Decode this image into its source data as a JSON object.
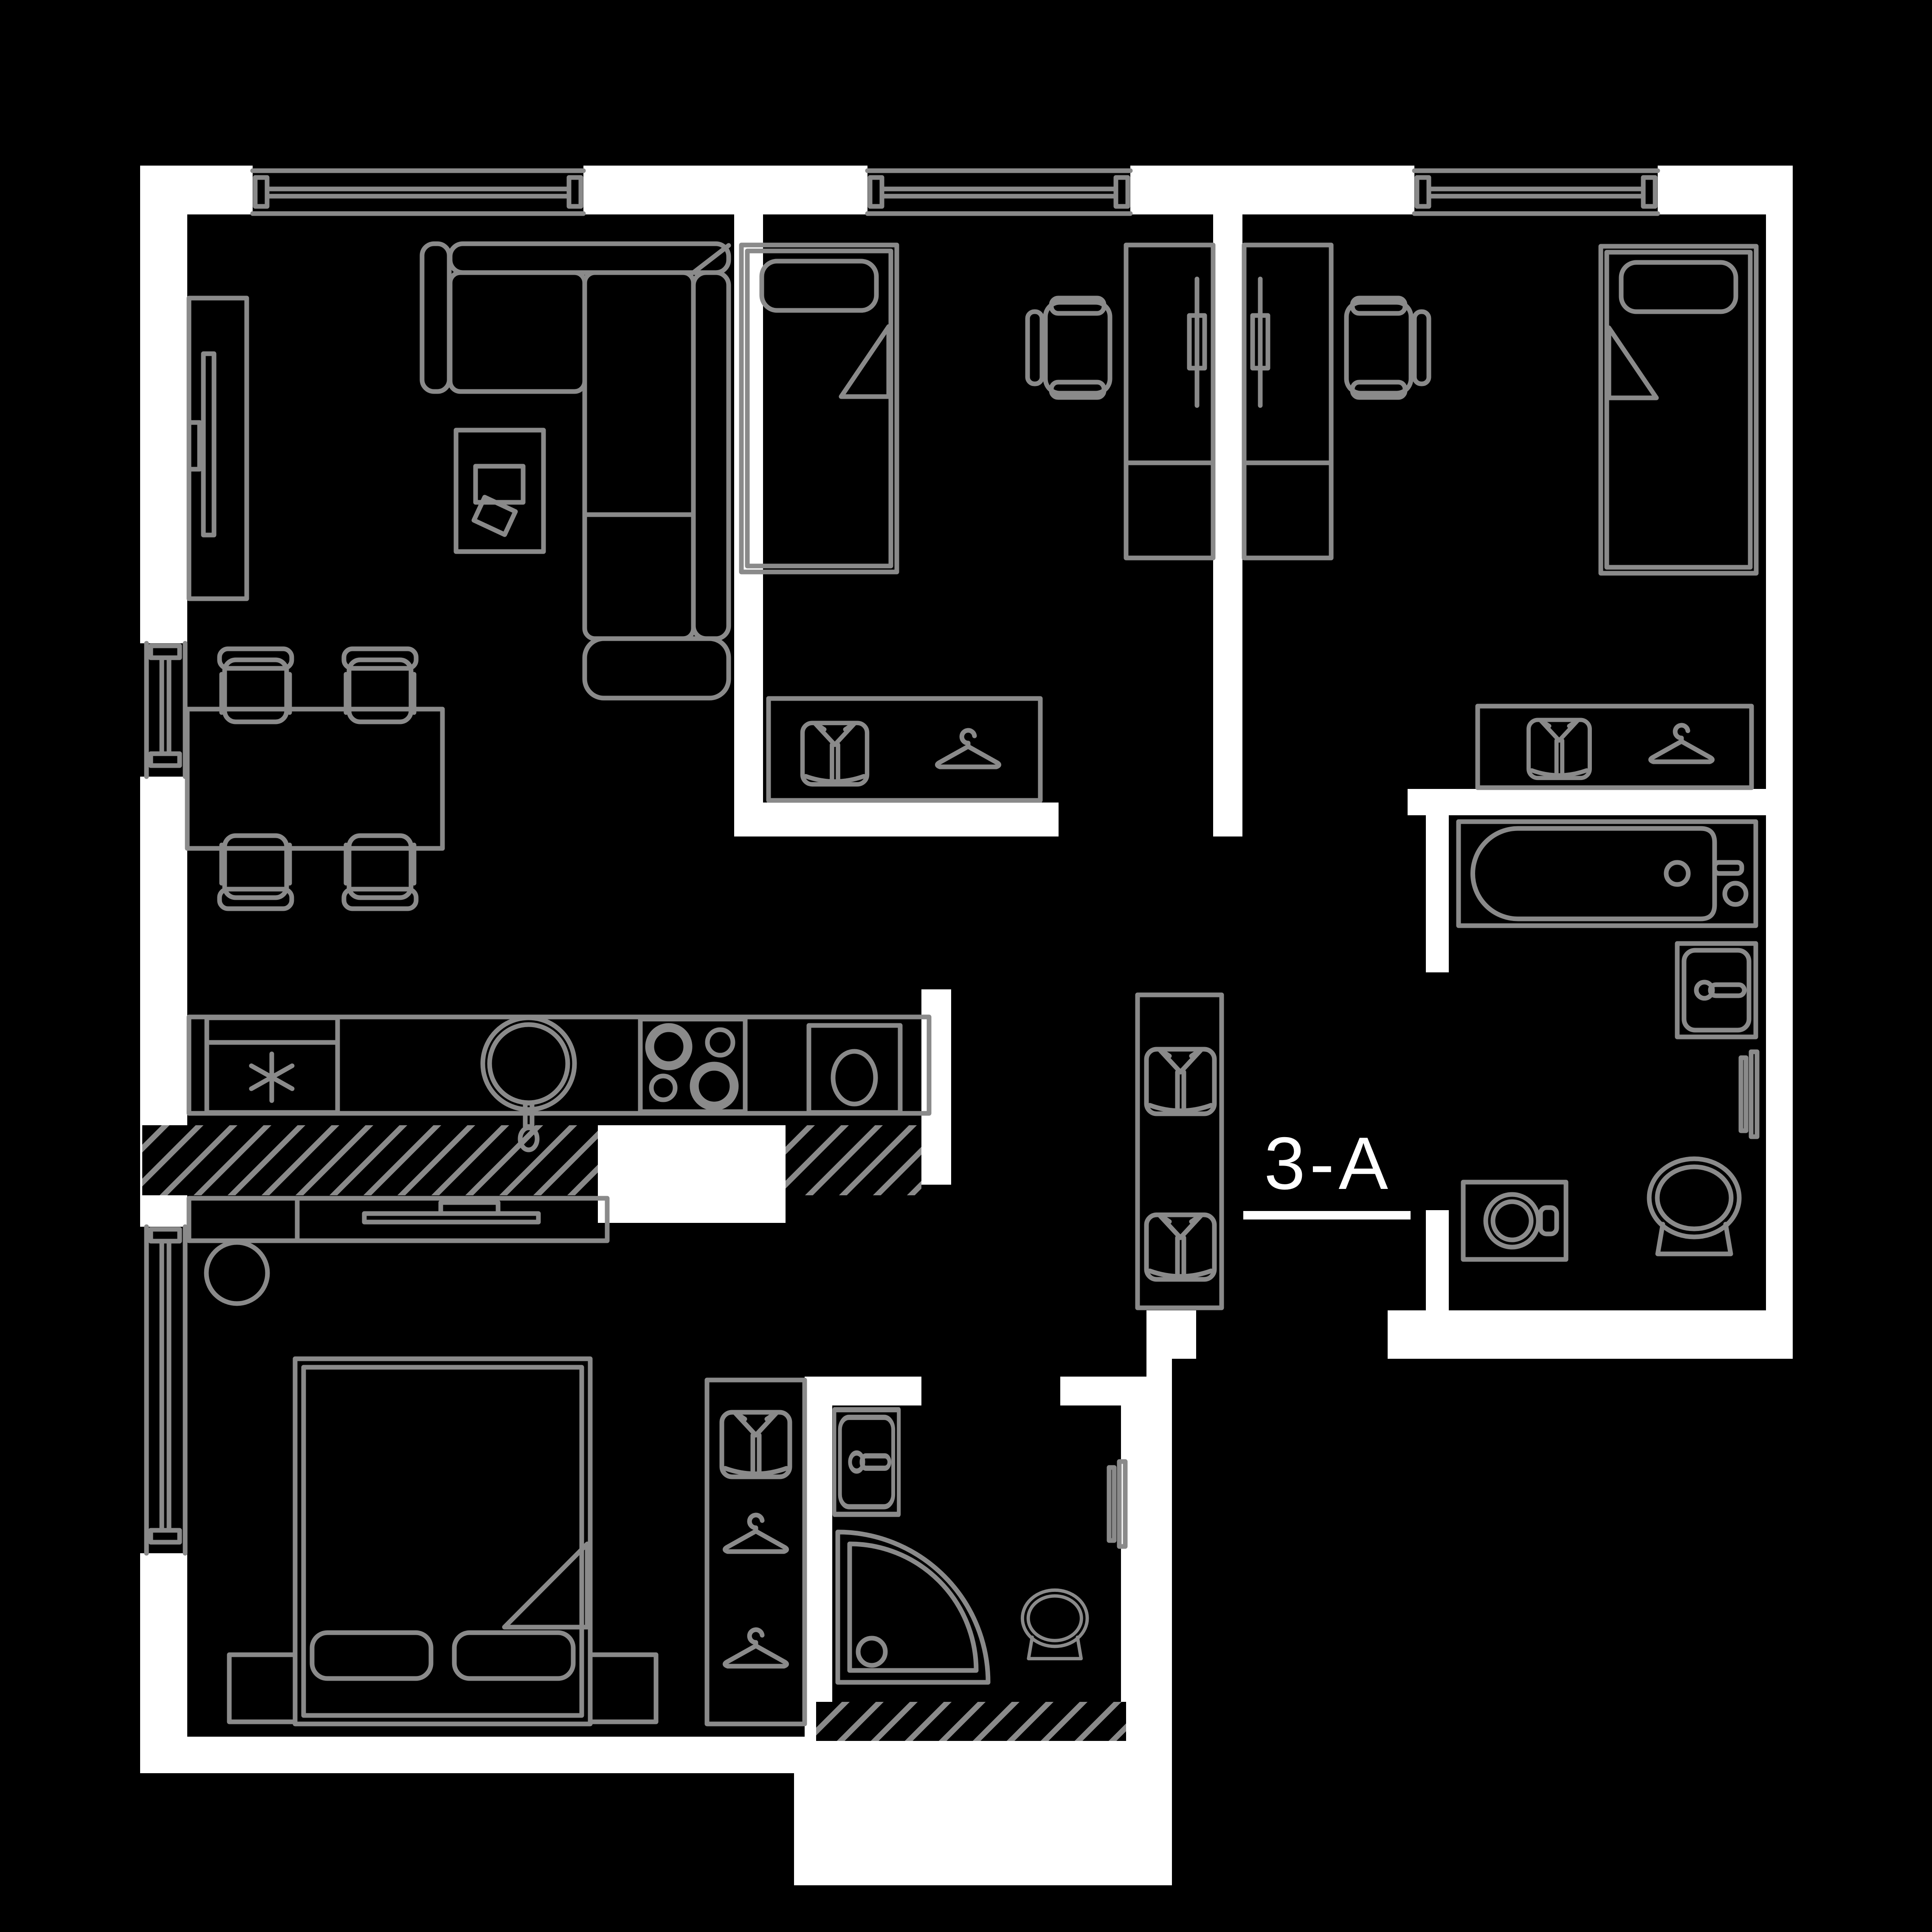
{
  "unit": {
    "label": "3-A"
  },
  "palette": {
    "background": "#000000",
    "walls": "#ffffff",
    "furniture_lines": "#8a8a8a",
    "label_text": "#ffffff"
  },
  "plan": {
    "type": "apartment-floor-plan",
    "rooms": [
      {
        "name": "living-room",
        "depicted_items": [
          "tv-unit",
          "corner-sofa",
          "side-table",
          "dining-table",
          "dining-chair",
          "dining-chair",
          "dining-chair",
          "dining-chair"
        ],
        "windows": 2
      },
      {
        "name": "kitchen",
        "depicted_items": [
          "refrigerator-asterisk-icon",
          "round-sink",
          "cooktop-4-burner",
          "oven"
        ]
      },
      {
        "name": "bedroom-middle",
        "depicted_items": [
          "single-bed",
          "desk",
          "office-chair",
          "wardrobe",
          "shirt-icon",
          "hanger-icon"
        ],
        "windows": 1
      },
      {
        "name": "bedroom-right",
        "depicted_items": [
          "single-bed",
          "desk",
          "office-chair",
          "wardrobe",
          "shirt-icon",
          "hanger-icon"
        ],
        "windows": 1
      },
      {
        "name": "bathroom-main",
        "depicted_items": [
          "bathtub",
          "vanity-sink",
          "towel-rail",
          "washing-machine",
          "toilet"
        ]
      },
      {
        "name": "bedroom-master",
        "depicted_items": [
          "double-bed",
          "nightstand",
          "nightstand",
          "tv-dresser",
          "stool",
          "wardrobe",
          "shirt-icon",
          "hanger-icon",
          "hanger-icon"
        ],
        "windows": 1
      },
      {
        "name": "bathroom-second",
        "depicted_items": [
          "sink",
          "corner-shower",
          "toilet",
          "towel-rail"
        ]
      },
      {
        "name": "hallway",
        "depicted_items": [
          "closet",
          "shirt-icon",
          "shirt-icon"
        ]
      }
    ],
    "hatched_partitions": 3
  }
}
